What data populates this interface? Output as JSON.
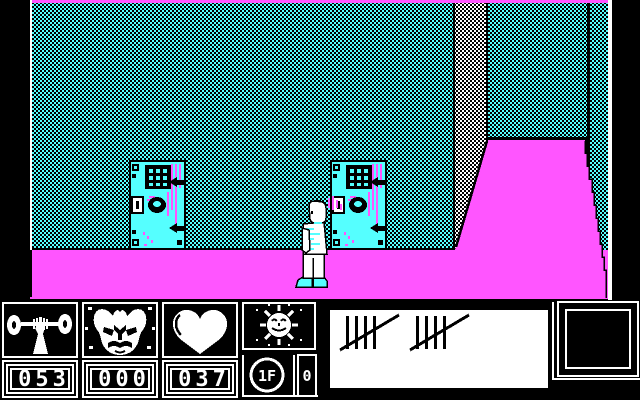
{
  "window": {
    "title": "CGA dungeon platformer screen"
  },
  "palette": {
    "magenta": "#FF55FF",
    "cyan": "#55FFFF",
    "white": "#FFFFFF",
    "black": "#000000"
  },
  "scene": {
    "wall_style": "cyan-black dither",
    "floor_color": "#FF55FF",
    "objects": {
      "door_left": "cell door with barred window",
      "door_right": "cell door with barred window",
      "ramp": "magenta slope on right",
      "player": "hero in white suit with cyan shoes"
    }
  },
  "hud": {
    "strength": {
      "icon": "barbell-icon",
      "value": "053"
    },
    "enemy": {
      "icon": "demon-icon",
      "value": "000"
    },
    "health": {
      "icon": "heart-icon",
      "value": "037"
    },
    "time": {
      "icon": "sun-icon"
    },
    "money": {
      "icon": "coin-icon",
      "coin_label": "1F",
      "value": "0"
    },
    "tally": {
      "icon": "tally-marks",
      "count": 10,
      "groups": [
        5,
        5
      ]
    },
    "inventory": {
      "state": "empty"
    }
  }
}
